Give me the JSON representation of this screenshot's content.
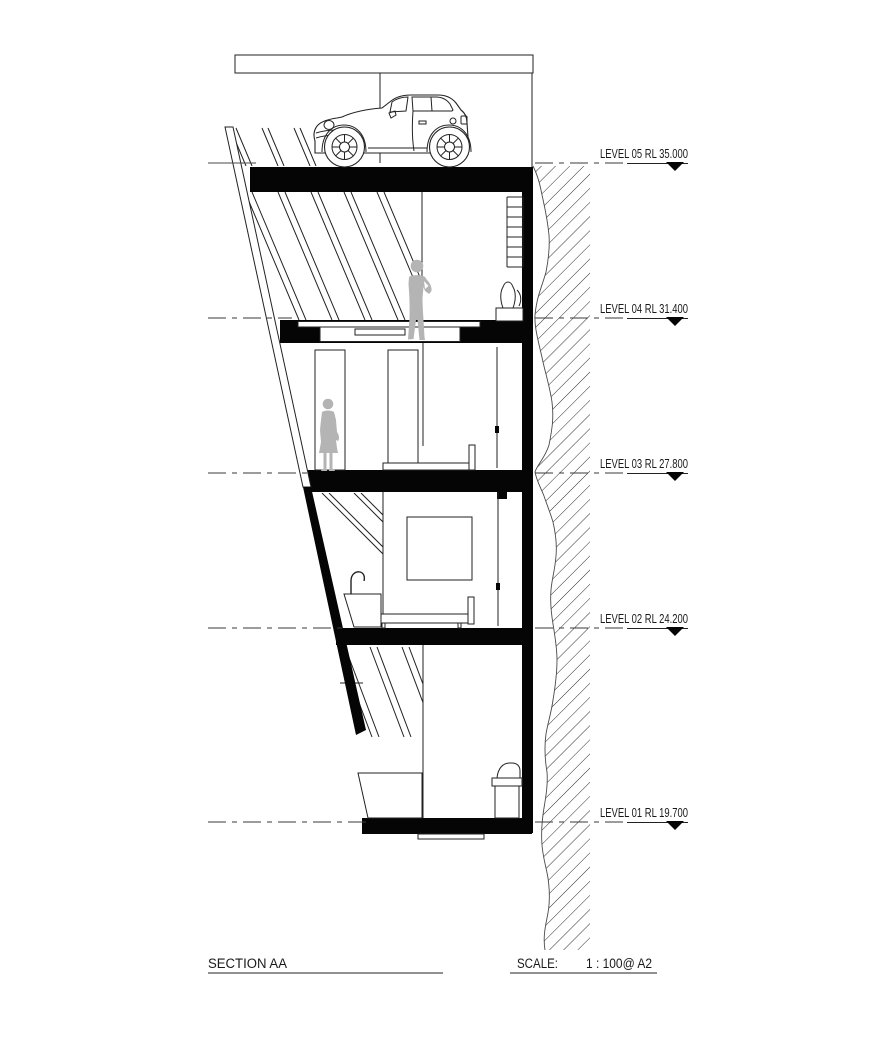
{
  "drawing": {
    "title_block": {
      "title": "SECTION AA",
      "scale_label": "SCALE:",
      "scale_value": "1 : 100@ A2"
    },
    "levels": [
      {
        "id": "level-05",
        "label": "LEVEL 05 RL 35.000",
        "rl": "35.000"
      },
      {
        "id": "level-04",
        "label": "LEVEL 04 RL 31.400",
        "rl": "31.400"
      },
      {
        "id": "level-03",
        "label": "LEVEL 03 RL 27.800",
        "rl": "27.800"
      },
      {
        "id": "level-02",
        "label": "LEVEL 02 RL 24.200",
        "rl": "24.200"
      },
      {
        "id": "level-01",
        "label": "LEVEL 01 RL 19.700",
        "rl": "19.700"
      }
    ],
    "colors": {
      "ink": "#222222",
      "solid_fill": "#050505",
      "figure_gray": "#b4b4b4",
      "background": "#ffffff"
    }
  }
}
